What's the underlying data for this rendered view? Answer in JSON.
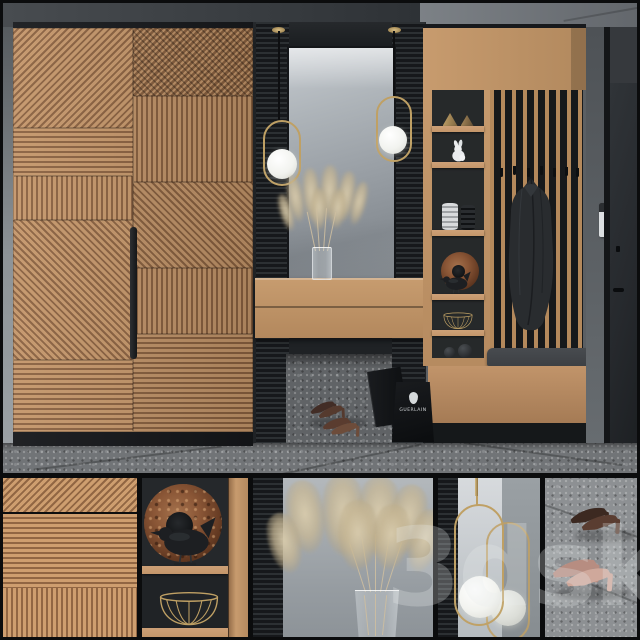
{
  "meta": {
    "kind": "3d-interior-render",
    "subject": "Hallway furniture set: slatted wardrobe, mirror with pendant lamps, console, open shelving, coat rack and bench"
  },
  "watermark": {
    "text": "3dsky"
  },
  "shopping_bag": {
    "brand": "GUERLAIN"
  },
  "bottom_panels": [
    {
      "name": "wood-slat-pattern-detail"
    },
    {
      "name": "decor-shelf-bird-detail"
    },
    {
      "name": "pampas-vase-detail"
    },
    {
      "name": "pendant-lamp-detail"
    },
    {
      "name": "heels-floor-detail"
    }
  ],
  "palette": {
    "frame": "#0b0c0d",
    "wood": "#c4966a",
    "woodShade": "#8a6140",
    "woodLight": "#cda077",
    "woodDeep": "#9c744e",
    "panel": "#1f2225",
    "slatWood": "#b4895c",
    "brass": "#bfa064",
    "mirrorHi": "#c6cbd0",
    "mirrorMid": "#9aa0a6",
    "mirrorLo": "#868c92",
    "wallLeft": "#8d9397",
    "wallRight": "#5b5f63",
    "ceilLeft": "#3f4347",
    "ceilRight": "#75797e",
    "floor": "#717477",
    "floorGap": "#606366",
    "floorLight": "#8d9093",
    "cushion": "#3d4044",
    "coat": "#292c2f",
    "rust": "#8a5636",
    "rustDeep": "#4f2c18",
    "plumeA": "#d8cbac",
    "plumeB": "#b9a884",
    "door": "#26292d",
    "white": "#e9ebed",
    "bird": "#1d1f22",
    "bag": "#101214"
  }
}
